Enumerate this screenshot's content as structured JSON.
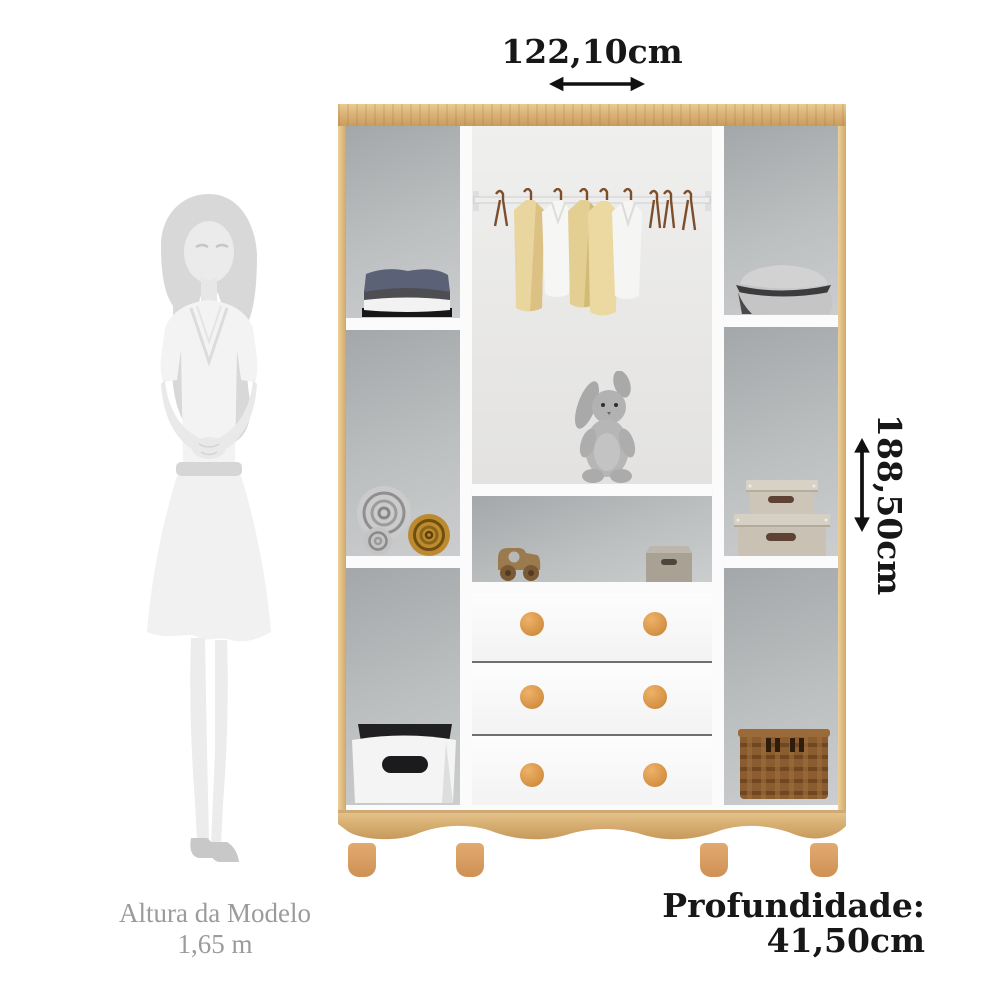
{
  "dims": {
    "width": "122,10cm",
    "height": "188,50cm",
    "depth_label": "Profundidade:",
    "depth_value": "41,50cm"
  },
  "model": {
    "label": "Altura da Modelo",
    "height": "1,65 m"
  },
  "icons": {
    "width_arrow": "horizontal-double-arrow-icon",
    "height_arrow": "vertical-double-arrow-icon",
    "model_silhouette": "woman-silhouette"
  },
  "colors": {
    "text": "#171717",
    "muted_text": "#9b9b9b",
    "wood": "#d9b075",
    "knob": "#d59345",
    "back_panel": "#bcbfc0",
    "white_panel": "#fbfbfb",
    "background": "#ffffff"
  },
  "wardrobe": {
    "sections": [
      "left-column",
      "center-column",
      "right-column"
    ],
    "contents": [
      "folded-clothes",
      "hanging-shirts",
      "empty-hangers",
      "pillows",
      "rolled-blankets",
      "plush-bunny",
      "storage-boxes",
      "toy-car",
      "small-box",
      "three-drawers",
      "storage-bin",
      "wicker-basket"
    ],
    "drawer_count": 3,
    "feet_count": 4
  }
}
